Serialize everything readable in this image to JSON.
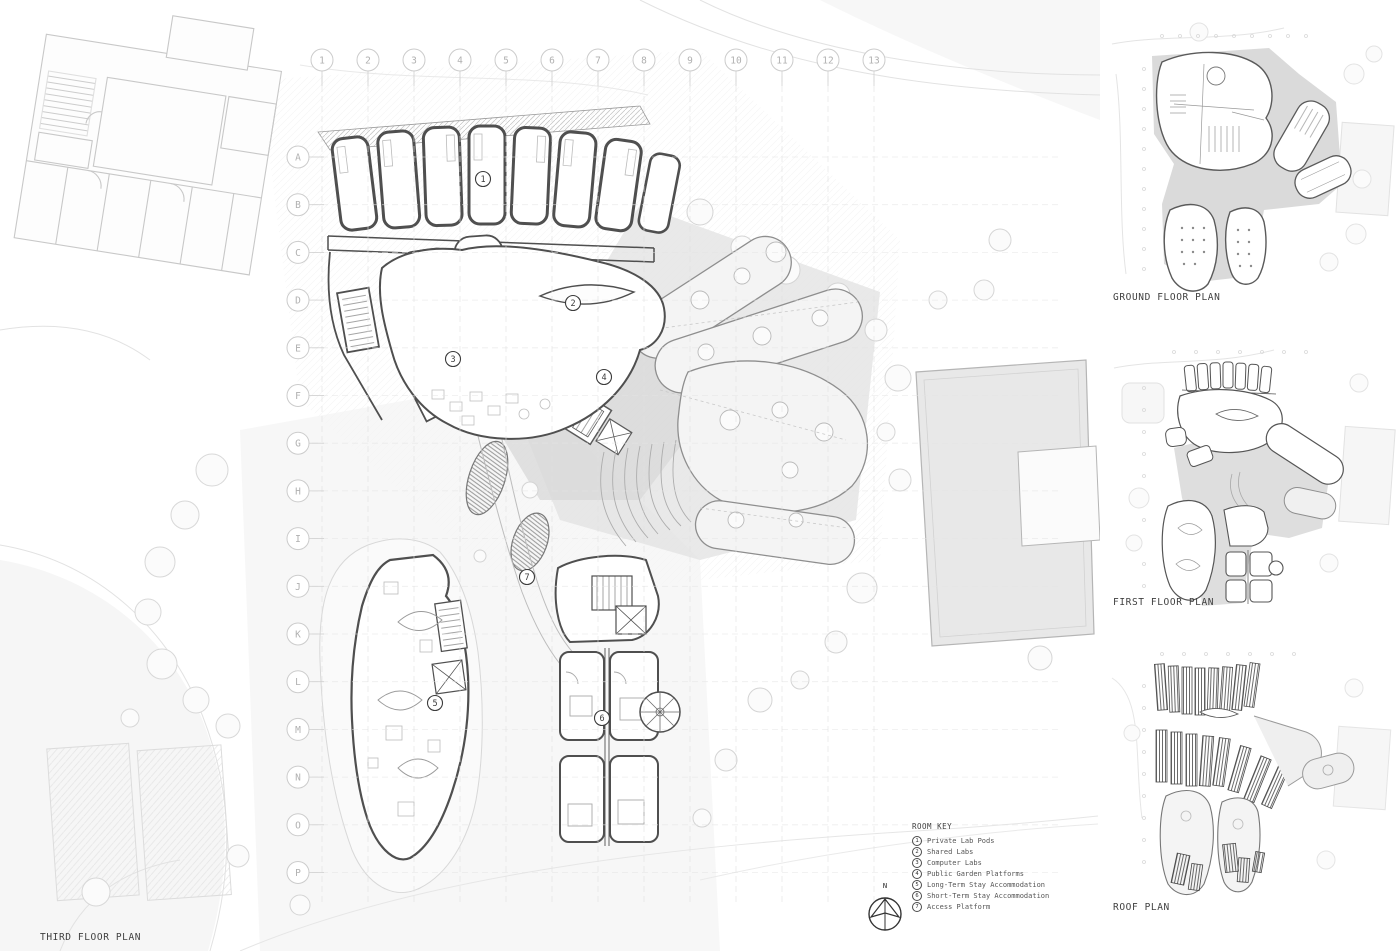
{
  "main_plan": {
    "caption": "THIRD FLOOR PLAN",
    "north_label": "N",
    "grid_columns": [
      "1",
      "2",
      "3",
      "4",
      "5",
      "6",
      "7",
      "8",
      "9",
      "10",
      "11",
      "12",
      "13"
    ],
    "grid_rows": [
      "A",
      "B",
      "C",
      "D",
      "E",
      "F",
      "G",
      "H",
      "I",
      "J",
      "K",
      "L",
      "M",
      "N",
      "O",
      "P"
    ],
    "room_markers": [
      {
        "num": "1",
        "x": 483,
        "y": 179
      },
      {
        "num": "2",
        "x": 573,
        "y": 303
      },
      {
        "num": "3",
        "x": 453,
        "y": 359
      },
      {
        "num": "4",
        "x": 604,
        "y": 377
      },
      {
        "num": "5",
        "x": 435,
        "y": 703
      },
      {
        "num": "6",
        "x": 602,
        "y": 718
      },
      {
        "num": "7",
        "x": 527,
        "y": 577
      }
    ]
  },
  "room_key": {
    "title": "ROOM KEY",
    "items": [
      {
        "num": "1",
        "label": "Private Lab Pods"
      },
      {
        "num": "2",
        "label": "Shared Labs"
      },
      {
        "num": "3",
        "label": "Computer Labs"
      },
      {
        "num": "4",
        "label": "Public Garden Platforms"
      },
      {
        "num": "5",
        "label": "Long-Term Stay Accommodation"
      },
      {
        "num": "6",
        "label": "Short-Term Stay Accommodation"
      },
      {
        "num": "7",
        "label": "Access Platform"
      }
    ]
  },
  "side_plans": [
    {
      "caption": "GROUND FLOOR PLAN"
    },
    {
      "caption": "FIRST FLOOR PLAN"
    },
    {
      "caption": "ROOF PLAN"
    }
  ],
  "colors": {
    "ink": "#4a4a4a",
    "context_line": "#c8c8c8",
    "site_shade": "#dcdcdc",
    "platform_fill": "#f3f3f3",
    "grid_label": "#b0b0b0",
    "label_text": "#3f3f3f"
  }
}
